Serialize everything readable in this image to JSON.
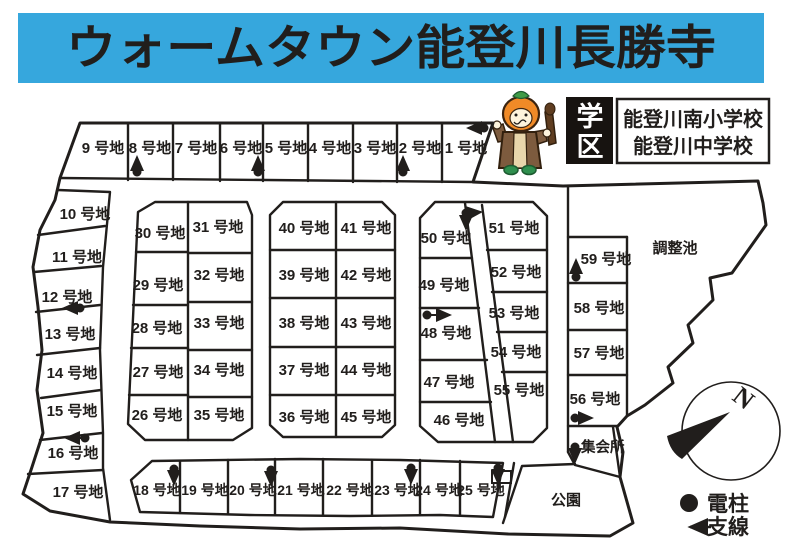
{
  "title": "ウォームタウン能登川長勝寺",
  "school_district": {
    "tag_chars": [
      "学",
      "区"
    ],
    "schools": [
      "能登川南小学校",
      "能登川中学校"
    ]
  },
  "lots": {
    "1": "1 号地",
    "2": "2 号地",
    "3": "3 号地",
    "4": "4 号地",
    "5": "5 号地",
    "6": "6 号地",
    "7": "7 号地",
    "8": "8 号地",
    "9": "9 号地",
    "10": "10 号地",
    "11": "11 号地",
    "12": "12 号地",
    "13": "13 号地",
    "14": "14 号地",
    "15": "15 号地",
    "16": "16 号地",
    "17": "17 号地",
    "18": "18 号地",
    "19": "19 号地",
    "20": "20 号地",
    "21": "21 号地",
    "22": "22 号地",
    "23": "23 号地",
    "24": "24 号地",
    "25": "25 号地",
    "26": "26 号地",
    "27": "27 号地",
    "28": "28 号地",
    "29": "29 号地",
    "30": "30 号地",
    "31": "31 号地",
    "32": "32 号地",
    "33": "33 号地",
    "34": "34 号地",
    "35": "35 号地",
    "36": "36 号地",
    "37": "37 号地",
    "38": "38 号地",
    "39": "39 号地",
    "40": "40 号地",
    "41": "41 号地",
    "42": "42 号地",
    "43": "43 号地",
    "44": "44 号地",
    "45": "45 号地",
    "46": "46 号地",
    "47": "47 号地",
    "48": "48 号地",
    "49": "49 号地",
    "50": "50 号地",
    "51": "51 号地",
    "52": "52 号地",
    "53": "53 号地",
    "54": "54 号地",
    "55": "55 号地",
    "56": "56 号地",
    "57": "57 号地",
    "58": "58 号地",
    "59": "59 号地"
  },
  "places": {
    "pond": "調整池",
    "park": "公園",
    "hall": "集会所"
  },
  "compass": {
    "north": "N"
  },
  "legend": {
    "pole_label": "電柱",
    "wire_label": "支線"
  },
  "colors": {
    "banner_bg": "#36a7dd",
    "ink": "#211e1c",
    "tag_box": "#171310",
    "mascot_orange": "#f08a27",
    "mascot_green": "#3f9b47",
    "mascot_brown": "#7d5b3e"
  }
}
